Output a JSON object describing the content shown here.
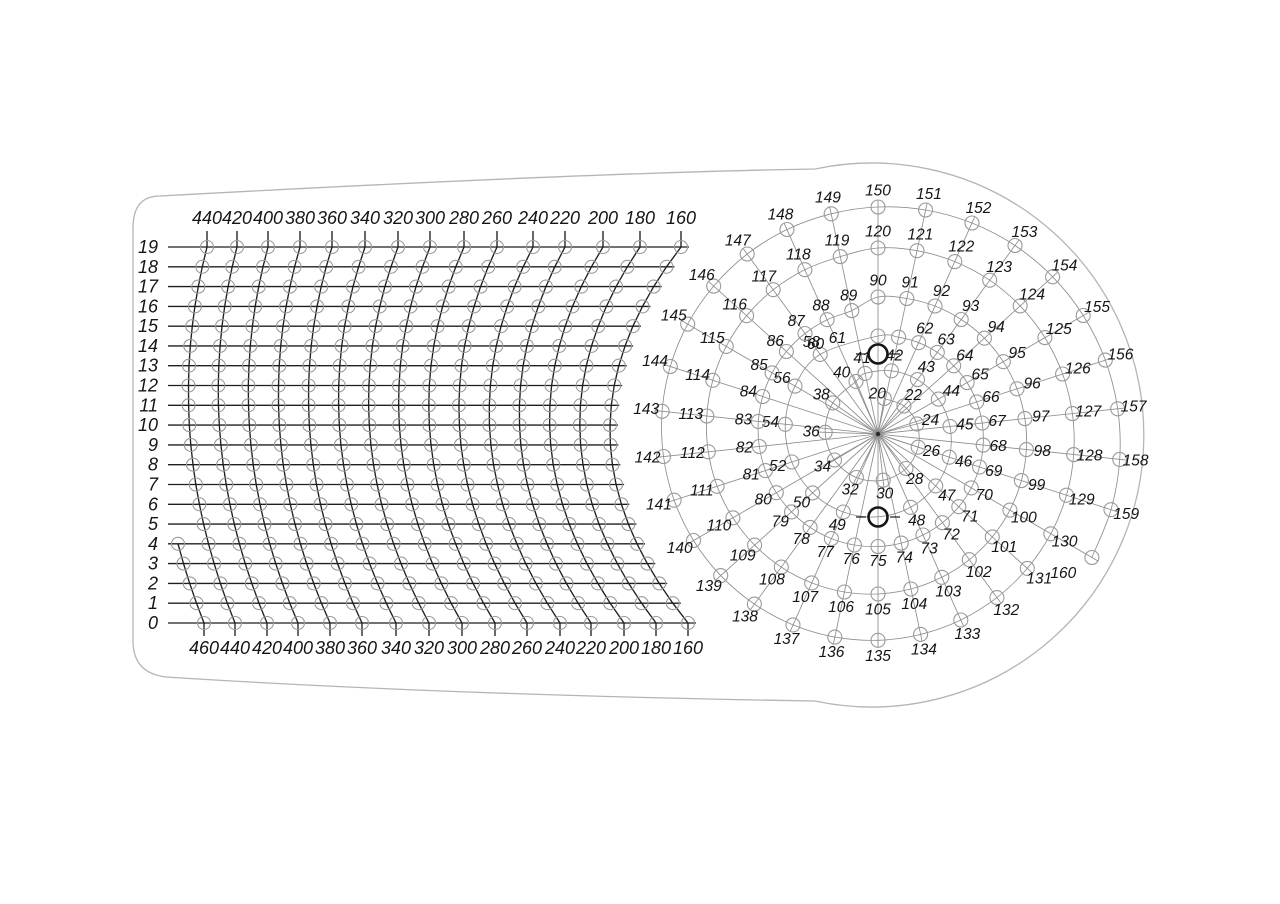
{
  "figure": {
    "description": "drilling template drawing with curved coordinate grid and spiral dial of numbered holes",
    "grid": {
      "row_labels": [
        "19",
        "18",
        "17",
        "16",
        "15",
        "14",
        "13",
        "12",
        "11",
        "10",
        "9",
        "8",
        "7",
        "6",
        "5",
        "4",
        "3",
        "2",
        "1",
        "0"
      ],
      "top_column_labels": [
        "440",
        "420",
        "400",
        "380",
        "360",
        "340",
        "320",
        "300",
        "280",
        "260",
        "240",
        "220",
        "200",
        "180",
        "160"
      ],
      "bottom_column_labels": [
        "460",
        "440",
        "420",
        "400",
        "380",
        "360",
        "340",
        "320",
        "300",
        "280",
        "260",
        "240",
        "220",
        "200",
        "180",
        "160"
      ]
    },
    "dial": {
      "rings": [
        {
          "name": "ring-1",
          "labels": [
            "20",
            "22",
            "24",
            "26",
            "28",
            "30",
            "32",
            "34",
            "36",
            "38",
            "40"
          ]
        },
        {
          "name": "ring-2",
          "labels": [
            "41",
            "42",
            "43",
            "44",
            "45",
            "46",
            "47",
            "48",
            "49",
            "50",
            "52",
            "54",
            "56",
            "58"
          ]
        },
        {
          "name": "ring-3",
          "labels": [
            "60",
            "61",
            "62",
            "63",
            "64",
            "65",
            "66",
            "67",
            "68",
            "69",
            "70",
            "71",
            "72",
            "73",
            "74",
            "75",
            "76",
            "77",
            "78",
            "79",
            "80",
            "81",
            "82",
            "83",
            "84",
            "85",
            "86",
            "87",
            "88",
            "89"
          ]
        },
        {
          "name": "ring-4",
          "labels": [
            "90",
            "91",
            "92",
            "93",
            "94",
            "95",
            "96",
            "97",
            "98",
            "99",
            "100",
            "101",
            "102",
            "103",
            "104",
            "105",
            "106",
            "107",
            "108",
            "109",
            "110",
            "111",
            "112",
            "113",
            "114",
            "115",
            "116",
            "117",
            "118",
            "119"
          ]
        },
        {
          "name": "ring-5",
          "labels": [
            "120",
            "121",
            "122",
            "123",
            "124",
            "125",
            "126",
            "127",
            "128",
            "129",
            "130",
            "131",
            "132",
            "133",
            "134",
            "135",
            "136",
            "137",
            "138",
            "139",
            "140",
            "141",
            "142",
            "143",
            "144",
            "145",
            "146",
            "147",
            "148",
            "149"
          ]
        },
        {
          "name": "ring-6",
          "labels": [
            "150",
            "151",
            "152",
            "153",
            "154",
            "155",
            "156",
            "157",
            "158",
            "159",
            "160"
          ]
        }
      ],
      "pivot_hole_count": "2"
    },
    "colors": {
      "background": "#ffffff",
      "grid_line": "#1f1f1f",
      "fine_line": "#8d8d8d",
      "hole_stroke": "#9a9a9a",
      "text": "#151515",
      "outline": "#b5b5b5",
      "pivot": "#161616"
    }
  }
}
